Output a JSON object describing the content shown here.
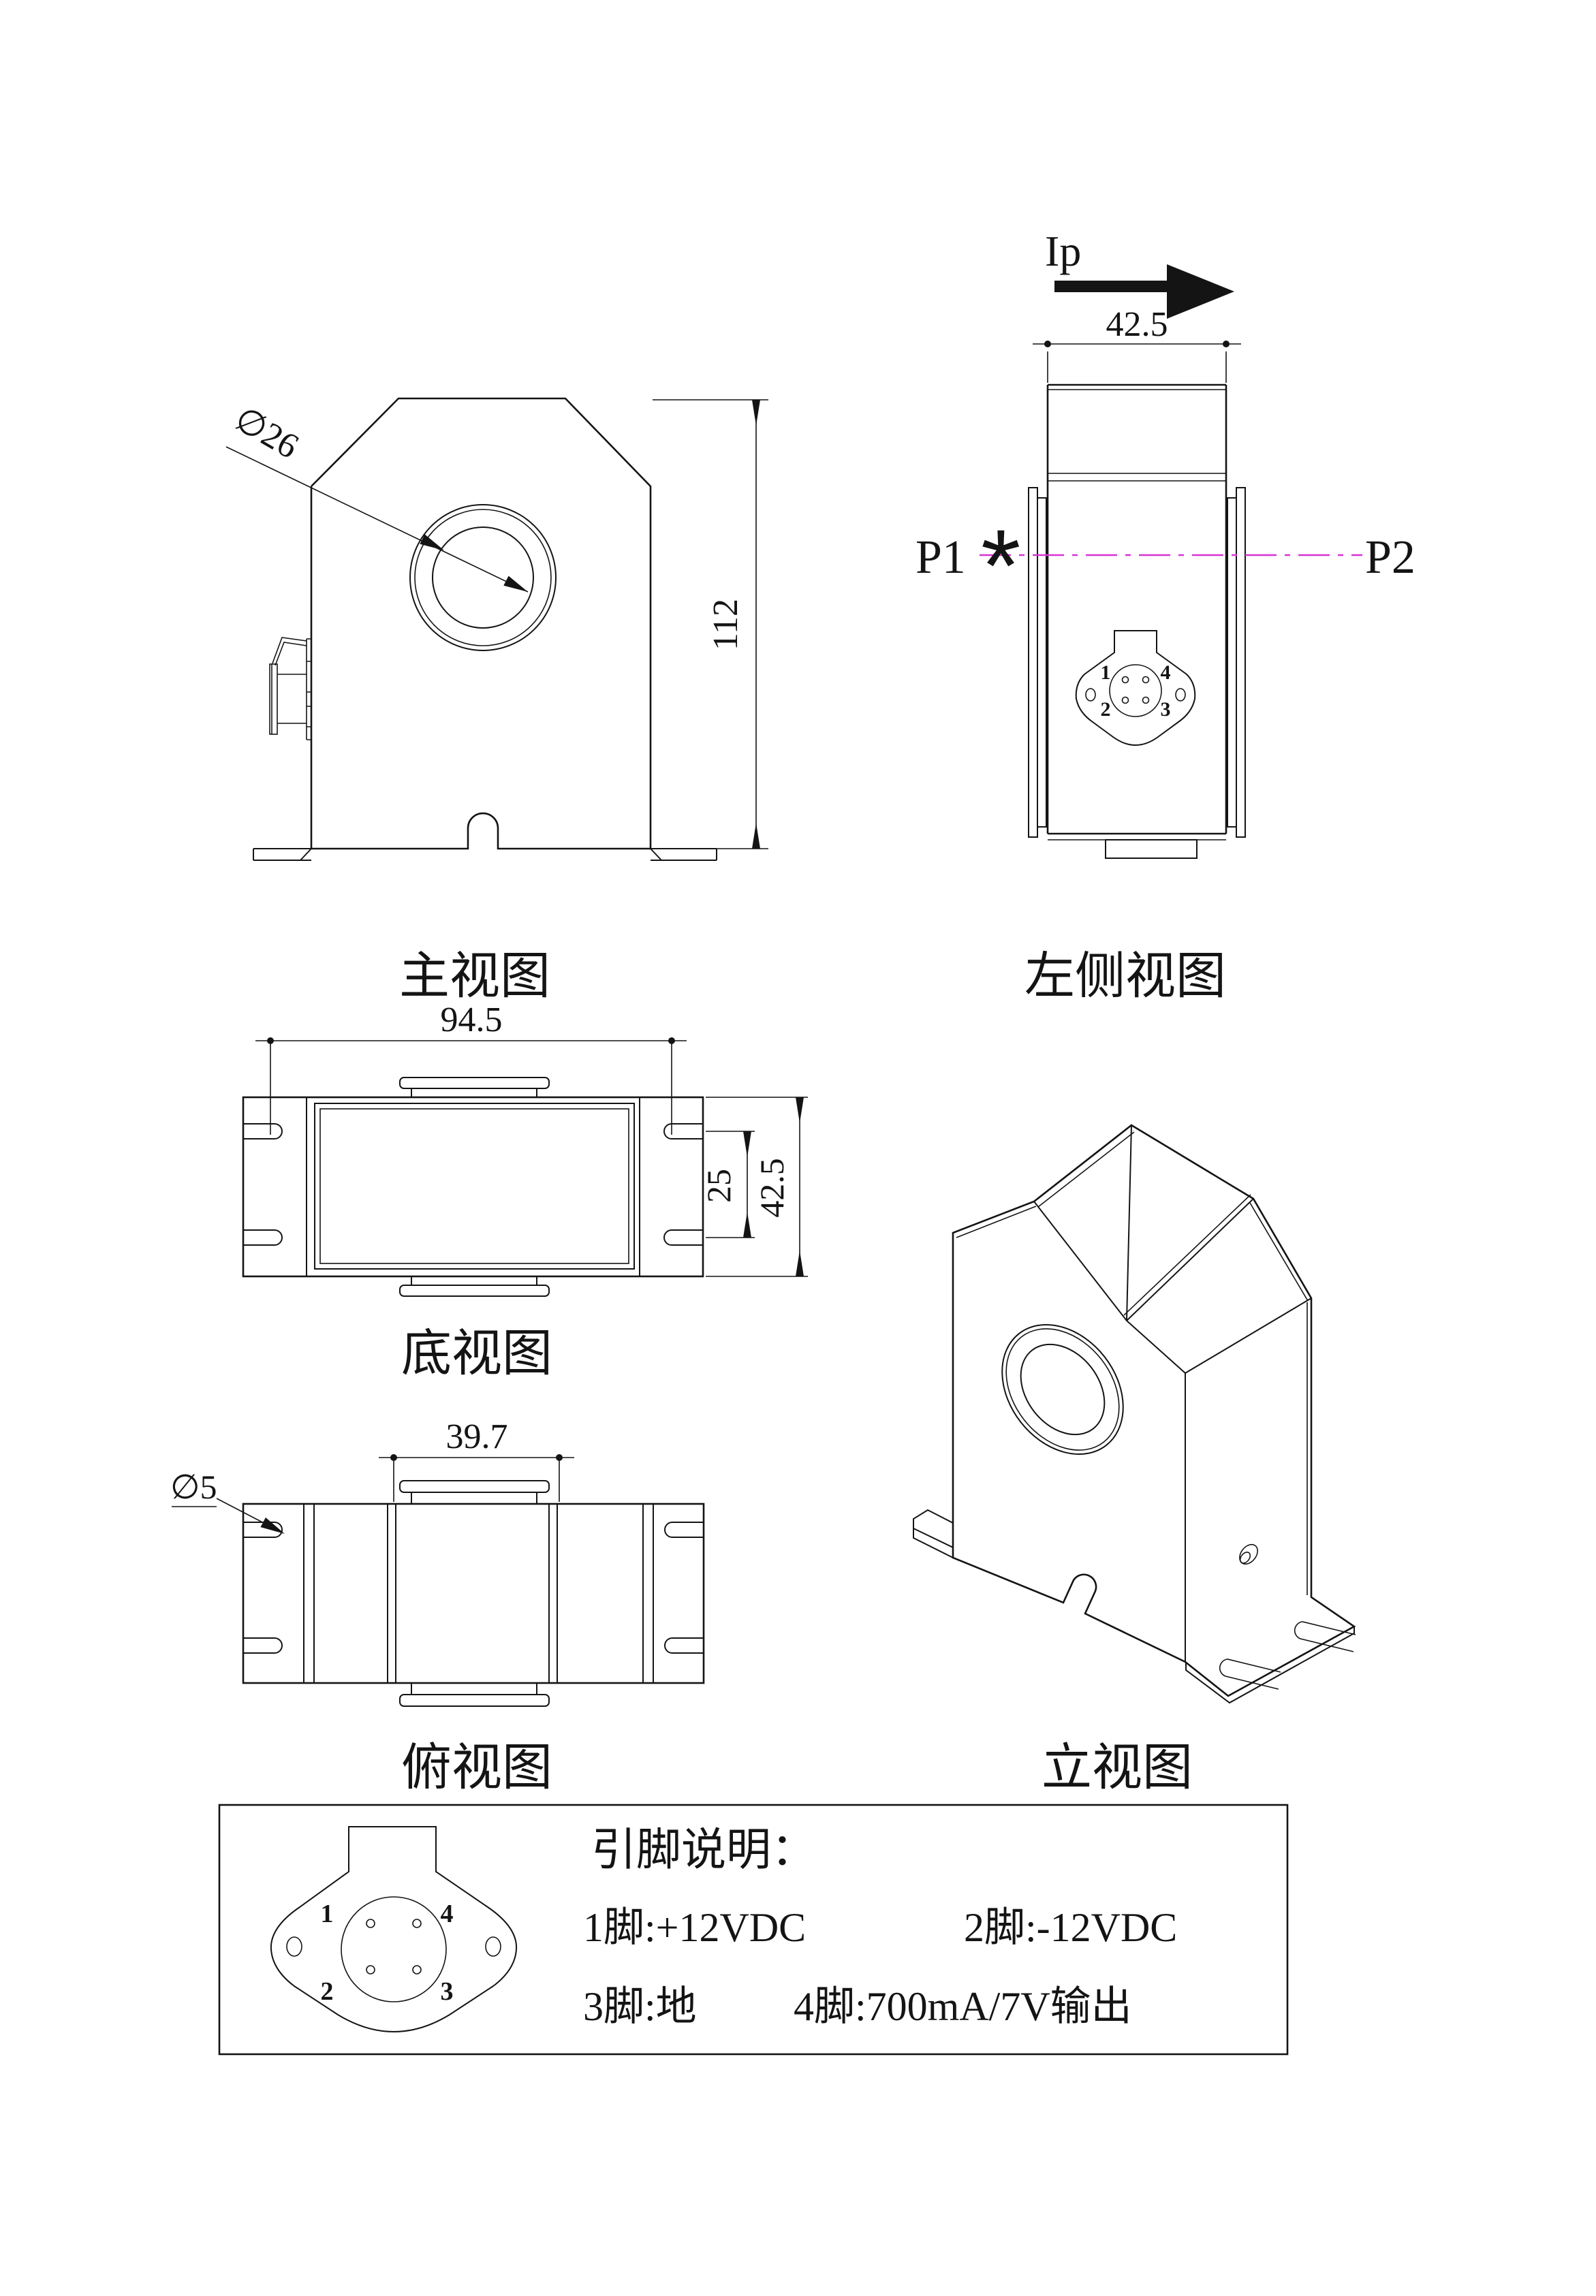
{
  "colors": {
    "line": "#141414",
    "accent_red": "#e60000",
    "centerline_magenta": "#d633d6"
  },
  "views": {
    "front": {
      "caption": "主视图",
      "hole_dia": "∅26",
      "height": "112"
    },
    "side": {
      "caption": "左侧视图",
      "width": "42.5",
      "current": "Ip",
      "p1": "P1",
      "p2": "P2",
      "star": "*",
      "pins": {
        "n1": "1",
        "n2": "2",
        "n3": "3",
        "n4": "4"
      }
    },
    "bottom": {
      "caption": "底视图",
      "width": "94.5",
      "slot_span": "25",
      "depth": "42.5"
    },
    "top": {
      "caption": "俯视图",
      "core_width": "39.7",
      "slot_dia": "∅5"
    },
    "iso": {
      "caption": "立视图"
    }
  },
  "pin_table": {
    "title": "引脚说明：",
    "row1_left": "1脚:+12VDC",
    "row1_right": "2脚:-12VDC",
    "row2_left": "3脚:地",
    "row2_right": "4脚:700mA/7V输出",
    "pins": {
      "n1": "1",
      "n2": "2",
      "n3": "3",
      "n4": "4"
    }
  }
}
